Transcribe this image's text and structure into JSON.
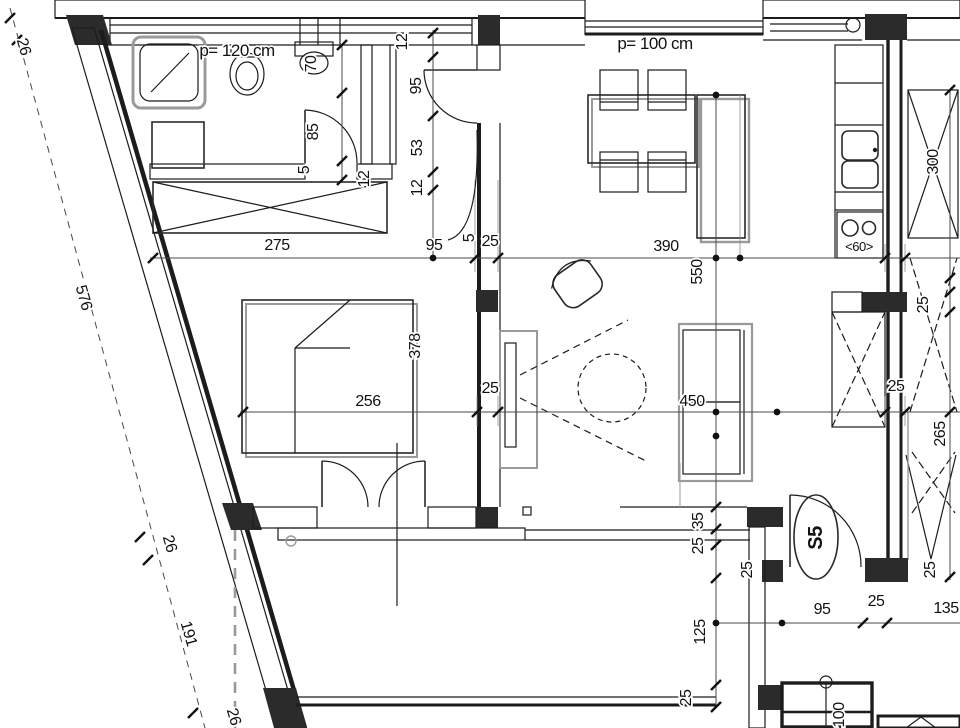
{
  "drawing": {
    "kind": "architectural-floor-plan",
    "apartment_label": "S5",
    "parapet_note_left": "p= 120 cm",
    "parapet_note_right": "p= 100 cm",
    "stove_width_note": "<60>"
  },
  "colors": {
    "line": "#1c1c1c",
    "furniture_shadow": "#9a9a9a",
    "dimension_line": "#4a4a4a",
    "solid_fill": "#2b2b2b",
    "background": "#ffffff"
  },
  "symbols": [
    "shower",
    "washing-machine",
    "toilet",
    "washbasin",
    "wardrobe",
    "bed",
    "double-swing-balcony-door",
    "dining-table",
    "dining-chair",
    "kitchen-island",
    "kitchen-counter",
    "kitchen-sink",
    "cooktop",
    "armchair",
    "coffee-table",
    "tv-cabinet",
    "sofa",
    "entry-door",
    "bathroom-door",
    "stair-direction-arrow",
    "shaft-cross-box",
    "insulated-exterior-wall"
  ],
  "labels": [
    {
      "id": "parapet-left",
      "text": "p= 120 cm"
    },
    {
      "id": "parapet-right",
      "text": "p= 100 cm"
    },
    {
      "id": "d70",
      "text": "70"
    },
    {
      "id": "d85",
      "text": "85"
    },
    {
      "id": "d5a",
      "text": "5"
    },
    {
      "id": "d12a",
      "text": "12"
    },
    {
      "id": "d12b",
      "text": "12"
    },
    {
      "id": "d95a",
      "text": "95"
    },
    {
      "id": "d53",
      "text": "53"
    },
    {
      "id": "d12c",
      "text": "12"
    },
    {
      "id": "d275",
      "text": "275"
    },
    {
      "id": "d95b",
      "text": "95"
    },
    {
      "id": "d5b",
      "text": "5"
    },
    {
      "id": "d25a",
      "text": "25"
    },
    {
      "id": "d390",
      "text": "390"
    },
    {
      "id": "d550",
      "text": "550"
    },
    {
      "id": "d300",
      "text": "300"
    },
    {
      "id": "d60",
      "text": "<60>"
    },
    {
      "id": "d256",
      "text": "256"
    },
    {
      "id": "d378",
      "text": "378"
    },
    {
      "id": "d25b",
      "text": "25"
    },
    {
      "id": "d450",
      "text": "450"
    },
    {
      "id": "d25c",
      "text": "25"
    },
    {
      "id": "d25d",
      "text": "25"
    },
    {
      "id": "d265",
      "text": "265"
    },
    {
      "id": "d576",
      "text": "576"
    },
    {
      "id": "d26a",
      "text": "26"
    },
    {
      "id": "d26b",
      "text": "26"
    },
    {
      "id": "d191",
      "text": "191"
    },
    {
      "id": "d26c",
      "text": "26"
    },
    {
      "id": "d35",
      "text": "35"
    },
    {
      "id": "d25e",
      "text": "25"
    },
    {
      "id": "d25f",
      "text": "25"
    },
    {
      "id": "s5",
      "text": "S5"
    },
    {
      "id": "d25g",
      "text": "25"
    },
    {
      "id": "d95c",
      "text": "95"
    },
    {
      "id": "d25h",
      "text": "25"
    },
    {
      "id": "d135",
      "text": "135"
    },
    {
      "id": "d125",
      "text": "125"
    },
    {
      "id": "d25i",
      "text": "25"
    },
    {
      "id": "d100",
      "text": "100"
    }
  ]
}
